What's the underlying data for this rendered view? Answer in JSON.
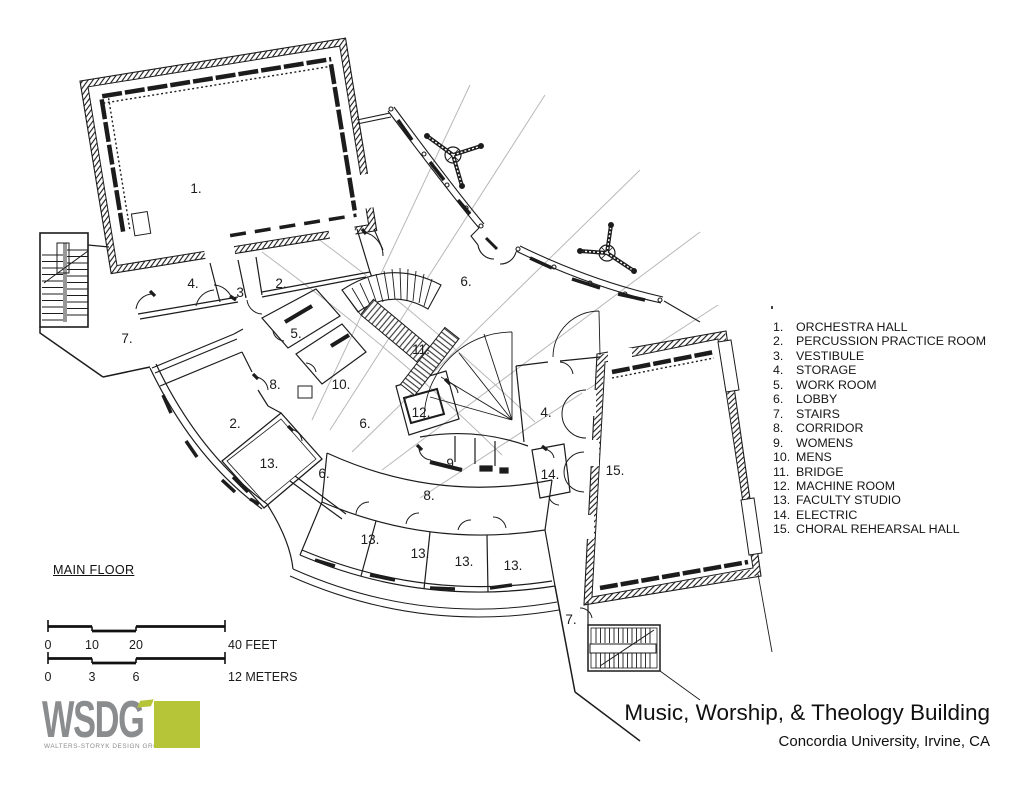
{
  "title": {
    "main": "Music, Worship, & Theology Building",
    "sub": "Concordia University, Irvine, CA"
  },
  "floor": {
    "label": "MAIN FLOOR"
  },
  "legend": {
    "items": [
      {
        "num": "1.",
        "name": "ORCHESTRA HALL"
      },
      {
        "num": "2.",
        "name": "PERCUSSION PRACTICE ROOM"
      },
      {
        "num": "3.",
        "name": "VESTIBULE"
      },
      {
        "num": "4.",
        "name": "STORAGE"
      },
      {
        "num": "5.",
        "name": "WORK ROOM"
      },
      {
        "num": "6.",
        "name": "LOBBY"
      },
      {
        "num": "7.",
        "name": "STAIRS"
      },
      {
        "num": "8.",
        "name": "CORRIDOR"
      },
      {
        "num": "9.",
        "name": "WOMENS"
      },
      {
        "num": "10.",
        "name": "MENS"
      },
      {
        "num": "11.",
        "name": "BRIDGE"
      },
      {
        "num": "12.",
        "name": "MACHINE ROOM"
      },
      {
        "num": "13.",
        "name": "FACULTY STUDIO"
      },
      {
        "num": "14.",
        "name": "ELECTRIC"
      },
      {
        "num": "15.",
        "name": "CHORAL REHEARSAL HALL"
      }
    ]
  },
  "plan": {
    "labels": [
      {
        "t": "1.",
        "x": 196,
        "y": 188
      },
      {
        "t": "4.",
        "x": 193,
        "y": 283
      },
      {
        "t": "3.",
        "x": 242,
        "y": 292
      },
      {
        "t": "2.",
        "x": 281,
        "y": 283
      },
      {
        "t": "6.",
        "x": 466,
        "y": 281
      },
      {
        "t": "7.",
        "x": 127,
        "y": 338
      },
      {
        "t": "5.",
        "x": 296,
        "y": 333
      },
      {
        "t": "11.",
        "x": 421,
        "y": 349
      },
      {
        "t": "8.",
        "x": 275,
        "y": 384
      },
      {
        "t": "10.",
        "x": 341,
        "y": 384
      },
      {
        "t": "2.",
        "x": 235,
        "y": 423
      },
      {
        "t": "12.",
        "x": 421,
        "y": 412
      },
      {
        "t": "6.",
        "x": 365,
        "y": 423
      },
      {
        "t": "4.",
        "x": 546,
        "y": 412
      },
      {
        "t": "13.",
        "x": 269,
        "y": 463
      },
      {
        "t": "6.",
        "x": 324,
        "y": 473
      },
      {
        "t": "9.",
        "x": 452,
        "y": 463
      },
      {
        "t": "14.",
        "x": 550,
        "y": 474
      },
      {
        "t": "15.",
        "x": 615,
        "y": 470
      },
      {
        "t": "8.",
        "x": 429,
        "y": 495
      },
      {
        "t": "13.",
        "x": 370,
        "y": 539
      },
      {
        "t": "13.",
        "x": 420,
        "y": 553
      },
      {
        "t": "13.",
        "x": 464,
        "y": 561
      },
      {
        "t": "13.",
        "x": 513,
        "y": 565
      },
      {
        "t": "7.",
        "x": 571,
        "y": 619
      }
    ]
  },
  "scale_bar": {
    "feet": [
      {
        "t": "0",
        "x": 48,
        "a": "middle"
      },
      {
        "t": "10",
        "x": 92,
        "a": "middle"
      },
      {
        "t": "20",
        "x": 136,
        "a": "middle"
      },
      {
        "t": "40 FEET",
        "x": 228,
        "a": "start"
      }
    ],
    "meters": [
      {
        "t": "0",
        "x": 48,
        "a": "middle"
      },
      {
        "t": "3",
        "x": 92,
        "a": "middle"
      },
      {
        "t": "6",
        "x": 136,
        "a": "middle"
      },
      {
        "t": "12 METERS",
        "x": 228,
        "a": "start"
      }
    ]
  },
  "logo": {
    "name": "WSDG",
    "tagline": "WALTERS-STORYK DESIGN GROUP",
    "accent_color": "#b6c437",
    "text_color": "#8a8c8e"
  },
  "colors": {
    "line": "#1c1c1c",
    "faint": "#b8b8b8"
  }
}
